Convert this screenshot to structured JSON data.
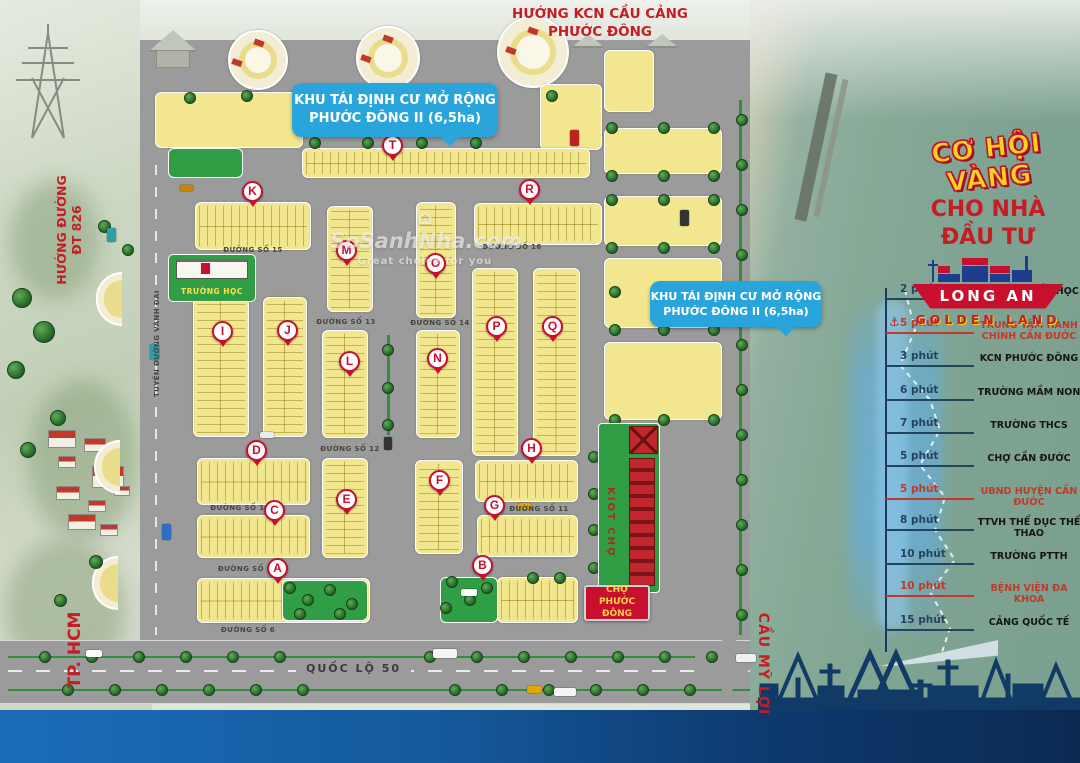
{
  "top_direction": {
    "line1": "HƯỚNG KCN CẦU CẢNG",
    "line2": "PHƯỚC ĐÔNG"
  },
  "callout_top": {
    "line1": "KHU TÁI ĐỊNH CƯ MỞ RỘNG",
    "line2": "PHƯỚC ĐÔNG II (6,5ha)"
  },
  "callout_right": {
    "line1": "KHU TÁI ĐỊNH CƯ MỞ RỘNG",
    "line2": "PHƯỚC ĐÔNG II (6,5ha)"
  },
  "left_direction": {
    "line1": "HƯỚNG ĐƯỜNG",
    "line2": "ĐT 826"
  },
  "bottom_left_direction": "TP. HCM",
  "bridge_direction": "CẦU MỸ LỢI",
  "highway_label": "QUỐC LỘ 50",
  "logo": {
    "headline": "CƠ HỘI VÀNG",
    "sub1": "CHO NHÀ",
    "sub2": "ĐẦU TƯ",
    "brand": "LONG AN",
    "brand_sub": "GOLDEN LAND",
    "anchor_icon": "⚓"
  },
  "watermark": {
    "name": "⌂ SoSanhNha.com",
    "tagline": "Great choice for you"
  },
  "landmarks": {
    "school": "TRƯỜNG HỌC",
    "kiosk_row": "KIOT CHỢ",
    "market": {
      "line1": "CHỢ",
      "line2": "PHƯỚC ĐÔNG"
    }
  },
  "map_markers": [
    "T",
    "K",
    "R",
    "M",
    "O",
    "I",
    "J",
    "P",
    "Q",
    "L",
    "N",
    "D",
    "H",
    "F",
    "E",
    "C",
    "G",
    "A",
    "B"
  ],
  "streets": [
    "ĐƯỜNG SỐ 15",
    "ĐƯỜNG SỐ 16",
    "ĐƯỜNG SỐ 13",
    "ĐƯỜNG SỐ 14",
    "ĐƯỜNG SỐ 12",
    "ĐƯỜNG SỐ 10",
    "ĐƯỜNG SỐ 11",
    "ĐƯỜNG SỐ 9",
    "ĐƯỜNG SỐ 6",
    "TUYẾN ĐƯỜNG VÀNH ĐAI"
  ],
  "timeline": [
    {
      "time": "2 phút",
      "label": "TRƯỜNG TIỂU HỌC",
      "highlight": false
    },
    {
      "time": "5 phút",
      "label": "TRUNG TÂM HÀNH CHÍNH CẦN ĐƯỚC",
      "highlight": true
    },
    {
      "time": "3 phút",
      "label": "KCN PHƯỚC ĐÔNG",
      "highlight": false
    },
    {
      "time": "6 phút",
      "label": "TRƯỜNG MẦM NON",
      "highlight": false
    },
    {
      "time": "7 phút",
      "label": "TRƯỜNG THCS",
      "highlight": false
    },
    {
      "time": "5 phút",
      "label": "CHỢ CẦN ĐƯỚC",
      "highlight": false
    },
    {
      "time": "5 phút",
      "label": "UBND HUYỆN CẦN ĐƯỚC",
      "highlight": true
    },
    {
      "time": "8 phút",
      "label": "TTVH THỂ DỤC THỂ THAO",
      "highlight": false
    },
    {
      "time": "10 phút",
      "label": "TRƯỜNG PTTH",
      "highlight": false
    },
    {
      "time": "10 phút",
      "label": "BỆNH VIỆN ĐA KHOA",
      "highlight": true
    },
    {
      "time": "15 phút",
      "label": "CẢNG QUỐC TẾ",
      "highlight": false
    }
  ],
  "colors": {
    "accent_red": "#c8102e",
    "banner_blue": "#29a5dc",
    "lot_yellow": "#f2e78e",
    "road_gray": "#9b9b9b",
    "river_teal": "#7fa392",
    "navy": "#123a66",
    "green": "#2f9e45",
    "logo_yellow": "#f7d321"
  }
}
